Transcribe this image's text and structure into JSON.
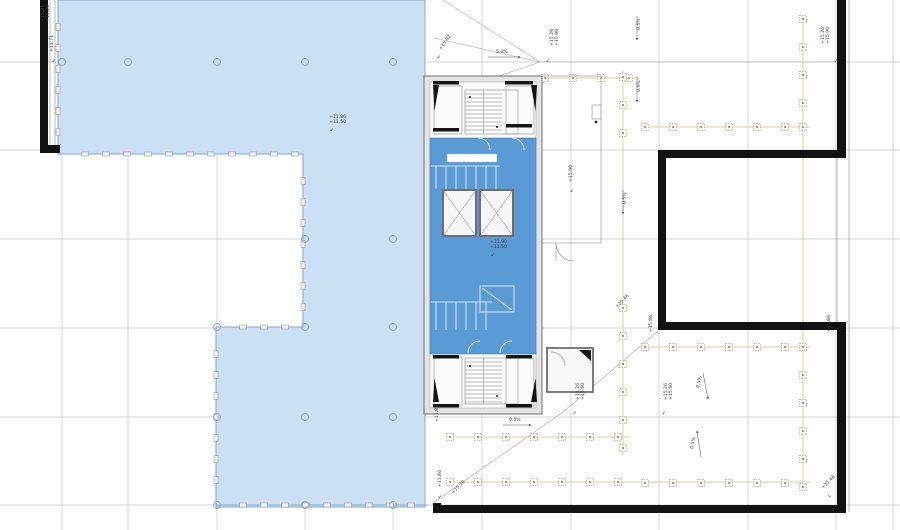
{
  "plan": {
    "name": "roof-floor-plan",
    "colors": {
      "blue_light": "#cbe0f4",
      "blue_mid": "#5b9bd5",
      "blue_edge": "#7da7cc",
      "wall_black": "#121212",
      "grid": "#c6c6c6",
      "guide": "#d8d0a0",
      "marker": "#b3ab85"
    },
    "grid": {
      "xs": [
        62,
        128,
        217,
        305,
        393,
        482,
        571,
        659,
        748,
        836,
        893
      ],
      "ys": [
        62,
        150,
        239,
        328,
        417,
        505
      ]
    },
    "floor_polygon": "58,0 425,0 425,507 216,507 216,327 303,327 303,154 58,154",
    "facade_edges": [
      {
        "x1": 58,
        "y1": 154,
        "x2": 303,
        "y2": 154
      },
      {
        "x1": 303,
        "y1": 154,
        "x2": 303,
        "y2": 327
      },
      {
        "x1": 216,
        "y1": 327,
        "x2": 303,
        "y2": 327
      },
      {
        "x1": 216,
        "y1": 327,
        "x2": 216,
        "y2": 505
      },
      {
        "x1": 216,
        "y1": 505,
        "x2": 428,
        "y2": 505
      },
      {
        "x1": 58,
        "y1": 0,
        "x2": 58,
        "y2": 154
      }
    ],
    "node_circles": [
      [
        62,
        62
      ],
      [
        128,
        62
      ],
      [
        217,
        62
      ],
      [
        305,
        62
      ],
      [
        393,
        62
      ],
      [
        305,
        239
      ],
      [
        393,
        239
      ],
      [
        217,
        327
      ],
      [
        305,
        327
      ],
      [
        393,
        327
      ],
      [
        217,
        417
      ],
      [
        305,
        417
      ],
      [
        393,
        417
      ],
      [
        217,
        505
      ],
      [
        305,
        505
      ],
      [
        393,
        505
      ]
    ],
    "black_walls": [
      [
        40,
        0,
        8,
        152
      ],
      [
        40,
        145,
        20,
        8
      ],
      [
        837,
        0,
        9,
        158
      ],
      [
        658,
        150,
        188,
        8
      ],
      [
        658,
        150,
        8,
        180
      ],
      [
        658,
        322,
        188,
        8
      ],
      [
        837,
        322,
        9,
        190
      ],
      [
        433,
        505,
        413,
        8
      ],
      [
        433,
        503,
        8,
        10
      ]
    ],
    "thin_lines": [
      [
        50,
        0,
        50,
        150
      ],
      [
        55,
        0,
        55,
        150
      ],
      [
        849,
        0,
        849,
        512
      ],
      [
        837,
        158,
        837,
        322
      ]
    ],
    "guide_lines": [
      [
        450,
        437,
        630,
        437
      ],
      [
        450,
        482,
        810,
        482
      ],
      [
        645,
        127,
        810,
        127
      ],
      [
        645,
        347,
        810,
        347
      ],
      [
        803,
        15,
        803,
        490
      ],
      [
        623,
        70,
        623,
        455
      ],
      [
        545,
        78,
        640,
        78
      ]
    ],
    "pedestal_markers": [
      [
        545,
        78
      ],
      [
        573,
        78
      ],
      [
        601,
        78
      ],
      [
        629,
        78
      ],
      [
        645,
        127
      ],
      [
        673,
        127
      ],
      [
        701,
        127
      ],
      [
        729,
        127
      ],
      [
        757,
        127
      ],
      [
        785,
        127
      ],
      [
        803,
        127
      ],
      [
        803,
        19
      ],
      [
        803,
        47
      ],
      [
        803,
        75
      ],
      [
        803,
        103
      ],
      [
        645,
        347
      ],
      [
        673,
        347
      ],
      [
        701,
        347
      ],
      [
        729,
        347
      ],
      [
        757,
        347
      ],
      [
        785,
        347
      ],
      [
        803,
        347
      ],
      [
        803,
        375
      ],
      [
        803,
        403
      ],
      [
        803,
        431
      ],
      [
        803,
        459
      ],
      [
        803,
        487
      ],
      [
        645,
        483
      ],
      [
        673,
        483
      ],
      [
        701,
        483
      ],
      [
        729,
        483
      ],
      [
        757,
        483
      ],
      [
        785,
        483
      ],
      [
        623,
        77
      ],
      [
        623,
        105
      ],
      [
        623,
        133
      ],
      [
        623,
        308
      ],
      [
        623,
        336
      ],
      [
        623,
        364
      ],
      [
        623,
        392
      ],
      [
        623,
        420
      ],
      [
        623,
        448
      ],
      [
        450,
        437
      ],
      [
        478,
        437
      ],
      [
        506,
        437
      ],
      [
        534,
        437
      ],
      [
        562,
        437
      ],
      [
        590,
        437
      ],
      [
        618,
        437
      ],
      [
        450,
        482
      ],
      [
        478,
        482
      ],
      [
        506,
        482
      ],
      [
        534,
        482
      ],
      [
        562,
        482
      ],
      [
        590,
        482
      ],
      [
        618,
        482
      ]
    ],
    "roof_diagonals": [
      [
        443,
        0,
        540,
        62
      ],
      [
        434,
        38,
        540,
        62
      ],
      [
        428,
        100,
        540,
        62
      ],
      [
        540,
        62,
        836,
        62
      ],
      [
        433,
        503,
        563,
        412
      ],
      [
        563,
        412,
        658,
        331
      ]
    ],
    "slope_arrows": [
      {
        "x1": 488,
        "y1": 57,
        "x2": 520,
        "y2": 57,
        "label": "5.0%",
        "lx": 496,
        "ly": 53,
        "rot": 0
      },
      {
        "x1": 503,
        "y1": 425,
        "x2": 531,
        "y2": 425,
        "label": "0.5%",
        "lx": 509,
        "ly": 421,
        "rot": 0
      },
      {
        "x1": 637,
        "y1": 16,
        "x2": 637,
        "y2": 40,
        "label": "0.5%",
        "lx": 640,
        "ly": 30,
        "rot": -90
      },
      {
        "x1": 637,
        "y1": 76,
        "x2": 637,
        "y2": 102,
        "label": "0.5%",
        "lx": 640,
        "ly": 92,
        "rot": -90
      },
      {
        "x1": 703,
        "y1": 373,
        "x2": 708,
        "y2": 399,
        "label": "0.5%",
        "lx": 699,
        "ly": 388,
        "rot": -78
      },
      {
        "x1": 701,
        "y1": 457,
        "x2": 697,
        "y2": 431,
        "label": "0.5%",
        "lx": 693,
        "ly": 449,
        "rot": -78
      },
      {
        "x1": 623,
        "y1": 190,
        "x2": 623,
        "y2": 214,
        "label": "0.5%",
        "lx": 626,
        "ly": 204,
        "rot": -90
      }
    ],
    "level_annotations": [
      {
        "x": 44,
        "y": 22,
        "rot": -90,
        "lines": [
          "+15.31",
          "+15.26"
        ]
      },
      {
        "x": 53,
        "y": 52,
        "rot": -90,
        "lines": [
          "+11.71"
        ],
        "ax": 52,
        "ay": 62,
        "aglyph": "↙"
      },
      {
        "x": 329,
        "y": 118,
        "rot": 0,
        "lines": [
          "+11.86",
          "+11.50"
        ],
        "ax": 330,
        "ay": 131,
        "aglyph": "↙"
      },
      {
        "x": 441,
        "y": 50,
        "rot": -55,
        "lines": [
          "+15.82"
        ],
        "ax": 437,
        "ay": 58,
        "aglyph": "↙"
      },
      {
        "x": 553,
        "y": 46,
        "rot": -90,
        "lines": [
          "+15.26",
          "+15.90"
        ],
        "ax": 546,
        "ay": 62,
        "aglyph": "↙"
      },
      {
        "x": 824,
        "y": 44,
        "rot": -90,
        "lines": [
          "+15.26",
          "+15.90"
        ],
        "ax": 834,
        "ay": 62,
        "aglyph": "↙"
      },
      {
        "x": 572,
        "y": 182,
        "rot": -90,
        "lines": [
          "+15.90"
        ],
        "ax": 570,
        "ay": 192,
        "aglyph": "↙"
      },
      {
        "x": 579,
        "y": 400,
        "rot": -90,
        "lines": [
          "+15.26",
          "+15.90"
        ],
        "ax": 573,
        "ay": 414,
        "aglyph": "↙"
      },
      {
        "x": 667,
        "y": 400,
        "rot": -90,
        "lines": [
          "+15.26",
          "+15.90"
        ],
        "ax": 662,
        "ay": 414,
        "aglyph": "↙"
      },
      {
        "x": 830,
        "y": 332,
        "rot": -90,
        "lines": [
          "+15.86"
        ]
      },
      {
        "x": 652,
        "y": 332,
        "rot": -90,
        "lines": [
          "+15.86"
        ]
      },
      {
        "x": 823,
        "y": 489,
        "rot": -45,
        "lines": [
          "+15.46"
        ],
        "ax": 827,
        "ay": 497,
        "aglyph": "↘"
      },
      {
        "x": 617,
        "y": 308,
        "rot": -45,
        "lines": [
          "+15.46"
        ]
      },
      {
        "x": 438,
        "y": 422,
        "rot": -90,
        "lines": [
          "+11.86"
        ]
      },
      {
        "x": 441,
        "y": 487,
        "rot": -90,
        "lines": [
          "+11.86"
        ],
        "ax": 438,
        "ay": 498,
        "aglyph": "↙"
      },
      {
        "x": 453,
        "y": 494,
        "rot": -45,
        "lines": [
          "+15.30"
        ]
      },
      {
        "x": 490,
        "y": 243,
        "rot": 0,
        "lines": [
          "+11.90",
          "+11.50"
        ],
        "ax": 491,
        "ay": 256,
        "aglyph": "↙"
      }
    ]
  }
}
